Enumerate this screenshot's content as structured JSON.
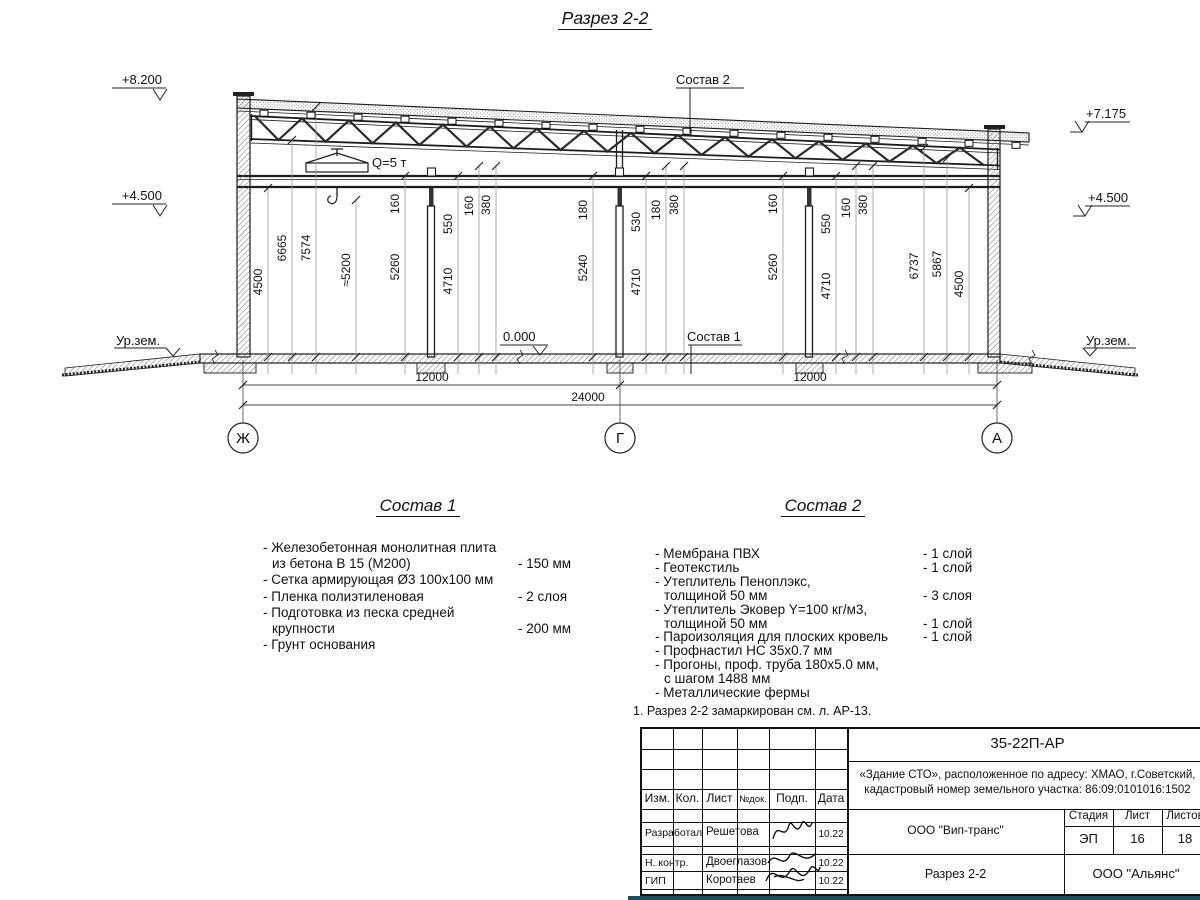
{
  "page_title": "Разрез 2-2",
  "drawing": {
    "elevations": {
      "left_top": "+8.200",
      "left_mid": "+4.500",
      "right_top": "+7.175",
      "right_mid": "+4.500",
      "zero": "0.000",
      "ground_left": "Ур.зем.",
      "ground_right": "Ур.зем."
    },
    "labels": {
      "sostav2": "Состав 2",
      "sostav1": "Состав 1",
      "crane": "Q=5 т"
    },
    "axes": [
      "Ж",
      "Г",
      "А"
    ],
    "dims_vertical": [
      "4500",
      "6665",
      "7574",
      "≈5200",
      "160",
      "5260",
      "550",
      "4710",
      "160",
      "380",
      "180",
      "5240",
      "530",
      "180",
      "380",
      "4710",
      "160",
      "5260",
      "550",
      "4710",
      "160",
      "380",
      "6737",
      "5867",
      "4500"
    ],
    "dims_horizontal": [
      "12000",
      "12000",
      "24000"
    ]
  },
  "sostav1": {
    "heading": "Состав 1",
    "rows": [
      {
        "t": "- Железобетонная  монолитная плита"
      },
      {
        "t": "из бетона В 15 (М200)",
        "v": "- 150 мм"
      },
      {
        "t": "- Сетка армирующая Ø3 100х100 мм"
      },
      {
        "t": "- Пленка полиэтиленовая",
        "v": "-  2 слоя"
      },
      {
        "t": "- Подготовка из песка средней"
      },
      {
        "t": "крупности",
        "v": "- 200 мм"
      },
      {
        "t": "- Грунт основания"
      }
    ]
  },
  "sostav2": {
    "heading": "Состав 2",
    "rows": [
      {
        "t": "- Мембрана ПВХ",
        "v": "- 1 слой"
      },
      {
        "t": "- Геотекстиль",
        "v": "- 1 слой"
      },
      {
        "t": "- Утеплитель Пеноплэкс,"
      },
      {
        "t": "толщиной 50 мм",
        "v": "- 3 слоя"
      },
      {
        "t": "- Утеплитель Эковер Y=100 кг/м3,"
      },
      {
        "t": "толщиной 50 мм",
        "v": "- 1 слой"
      },
      {
        "t": "- Пароизоляция для плоских кровель",
        "v": "- 1 слой"
      },
      {
        "t": "- Профнастил НС 35х0.7 мм"
      },
      {
        "t": "- Прогоны, проф. труба 180х5.0 мм,"
      },
      {
        "t": "с шагом 1488 мм"
      },
      {
        "t": "- Металлические фермы"
      }
    ]
  },
  "note": "1. Разрез 2-2 замаркирован см. л. АР-13.",
  "titleblock": {
    "doc_number": "35-22П-АР",
    "object_line1": "«Здание СТО», расположенное по адресу: ХМАО, г.Советский,",
    "object_line2": "кадастровый номер земельного участка: 86:09:0101016:1502",
    "header": {
      "izm": "Изм.",
      "kol": "Кол.",
      "list": "Лист",
      "ndok": "№док.",
      "podp": "Подп.",
      "data": "Дата"
    },
    "rows": [
      {
        "role": "Разработал",
        "name": "Решетова",
        "date": "10.22"
      },
      {
        "role": "Н. контр.",
        "name": "Двоеглазов",
        "date": "10.22"
      },
      {
        "role": "ГИП",
        "name": "Коротаев",
        "date": "10.22"
      }
    ],
    "org_design": "ООО \"Вип-транс\"",
    "stage_label": "Стадия",
    "sheet_label": "Лист",
    "sheets_label": "Листов",
    "stage": "ЭП",
    "sheet": "16",
    "sheets": "18",
    "sheet_title": "Разрез 2-2",
    "org_customer": "ООО \"Альянс\""
  }
}
